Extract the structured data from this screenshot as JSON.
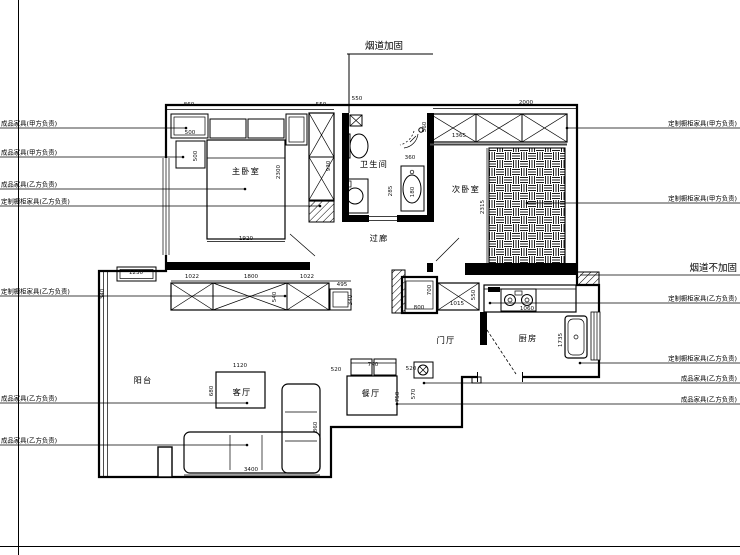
{
  "flue_top": {
    "label": "烟道加固"
  },
  "flue_right": {
    "label": "烟道不加固"
  },
  "rooms": [
    {
      "name": "主卧室",
      "x": 246,
      "y": 174
    },
    {
      "name": "卫生间",
      "x": 374,
      "y": 167
    },
    {
      "name": "次卧室",
      "x": 466,
      "y": 192
    },
    {
      "name": "过廊",
      "x": 379,
      "y": 241
    },
    {
      "name": "门厅",
      "x": 446,
      "y": 343
    },
    {
      "name": "厨房",
      "x": 528,
      "y": 341
    },
    {
      "name": "阳台",
      "x": 143,
      "y": 383
    },
    {
      "name": "客厅",
      "x": 242,
      "y": 395
    },
    {
      "name": "餐厅",
      "x": 371,
      "y": 396
    }
  ],
  "annotations": {
    "left": [
      {
        "label": "成品家具(甲方负责)",
        "tx": 186,
        "ty": 128
      },
      {
        "label": "成品家具(甲方负责)",
        "tx": 183,
        "ty": 157
      },
      {
        "label": "成品家具(乙方负责)",
        "tx": 245,
        "ty": 189
      },
      {
        "label": "定制橱柜家具(乙方负责)",
        "tx": 320,
        "ty": 206
      },
      {
        "label": "定制橱柜家具(乙方负责)",
        "tx": 285,
        "ty": 296
      },
      {
        "label": "成品家具(乙方负责)",
        "tx": 247,
        "ty": 403
      },
      {
        "label": "成品家具(乙方负责)",
        "tx": 247,
        "ty": 445
      }
    ],
    "right": [
      {
        "label": "定制橱柜家具(甲方负责)",
        "tx": 567,
        "ty": 128
      },
      {
        "label": "定制橱柜家具(甲方负责)",
        "tx": 527,
        "ty": 203
      },
      {
        "label": "烟道不加固",
        "tx": 580,
        "ty": 275,
        "big": true
      },
      {
        "label": "定制橱柜家具(乙方负责)",
        "tx": 490,
        "ty": 303
      },
      {
        "label": "定制橱柜家具(乙方负责)",
        "tx": 580,
        "ty": 363
      },
      {
        "label": "成品家具(乙方负责)",
        "tx": 424,
        "ty": 383
      },
      {
        "label": "成品家具(乙方负责)",
        "tx": 397,
        "ty": 404
      }
    ]
  },
  "dimensions": [
    {
      "v": "860",
      "x": 189,
      "y": 106,
      "rot": 0
    },
    {
      "v": "500",
      "x": 190,
      "y": 134,
      "rot": 0
    },
    {
      "v": "500",
      "x": 197,
      "y": 156,
      "rot": 90
    },
    {
      "v": "550",
      "x": 321,
      "y": 106,
      "rot": 0
    },
    {
      "v": "550",
      "x": 357,
      "y": 100,
      "rot": 0
    },
    {
      "v": "2000",
      "x": 526,
      "y": 104,
      "rot": 0
    },
    {
      "v": "1365",
      "x": 459,
      "y": 137,
      "rot": 0
    },
    {
      "v": "930",
      "x": 330,
      "y": 166,
      "rot": 90
    },
    {
      "v": "2300",
      "x": 280,
      "y": 172,
      "rot": 90
    },
    {
      "v": "1920",
      "x": 246,
      "y": 240,
      "rot": 0
    },
    {
      "v": "560",
      "x": 426,
      "y": 127,
      "rot": 90
    },
    {
      "v": "360",
      "x": 410,
      "y": 159,
      "rot": 0
    },
    {
      "v": "285",
      "x": 392,
      "y": 191,
      "rot": 90
    },
    {
      "v": "180",
      "x": 414,
      "y": 192,
      "rot": 90
    },
    {
      "v": "2315",
      "x": 484,
      "y": 207,
      "rot": 90
    },
    {
      "v": "1230",
      "x": 136,
      "y": 274,
      "rot": 0
    },
    {
      "v": "340",
      "x": 104,
      "y": 294,
      "rot": 90
    },
    {
      "v": "1022",
      "x": 192,
      "y": 278,
      "rot": 0
    },
    {
      "v": "1800",
      "x": 251,
      "y": 278,
      "rot": 0
    },
    {
      "v": "1022",
      "x": 307,
      "y": 278,
      "rot": 0
    },
    {
      "v": "495",
      "x": 342,
      "y": 286,
      "rot": 0
    },
    {
      "v": "540",
      "x": 276,
      "y": 297,
      "rot": 90
    },
    {
      "v": "340",
      "x": 352,
      "y": 300,
      "rot": 90
    },
    {
      "v": "800",
      "x": 419,
      "y": 309,
      "rot": 0
    },
    {
      "v": "700",
      "x": 431,
      "y": 290,
      "rot": 90
    },
    {
      "v": "1015",
      "x": 457,
      "y": 305,
      "rot": 0
    },
    {
      "v": "550",
      "x": 475,
      "y": 295,
      "rot": 90
    },
    {
      "v": "1060",
      "x": 527,
      "y": 310,
      "rot": 0
    },
    {
      "v": "1735",
      "x": 562,
      "y": 340,
      "rot": 90
    },
    {
      "v": "1120",
      "x": 240,
      "y": 367,
      "rot": 0
    },
    {
      "v": "680",
      "x": 213,
      "y": 391,
      "rot": 90
    },
    {
      "v": "3400",
      "x": 251,
      "y": 471,
      "rot": 0
    },
    {
      "v": "860",
      "x": 317,
      "y": 427,
      "rot": 90
    },
    {
      "v": "740",
      "x": 373,
      "y": 366,
      "rot": 0
    },
    {
      "v": "520",
      "x": 336,
      "y": 371,
      "rot": 0
    },
    {
      "v": "750",
      "x": 399,
      "y": 397,
      "rot": 90
    },
    {
      "v": "520",
      "x": 411,
      "y": 370,
      "rot": 0
    },
    {
      "v": "570",
      "x": 415,
      "y": 394,
      "rot": 90
    }
  ]
}
